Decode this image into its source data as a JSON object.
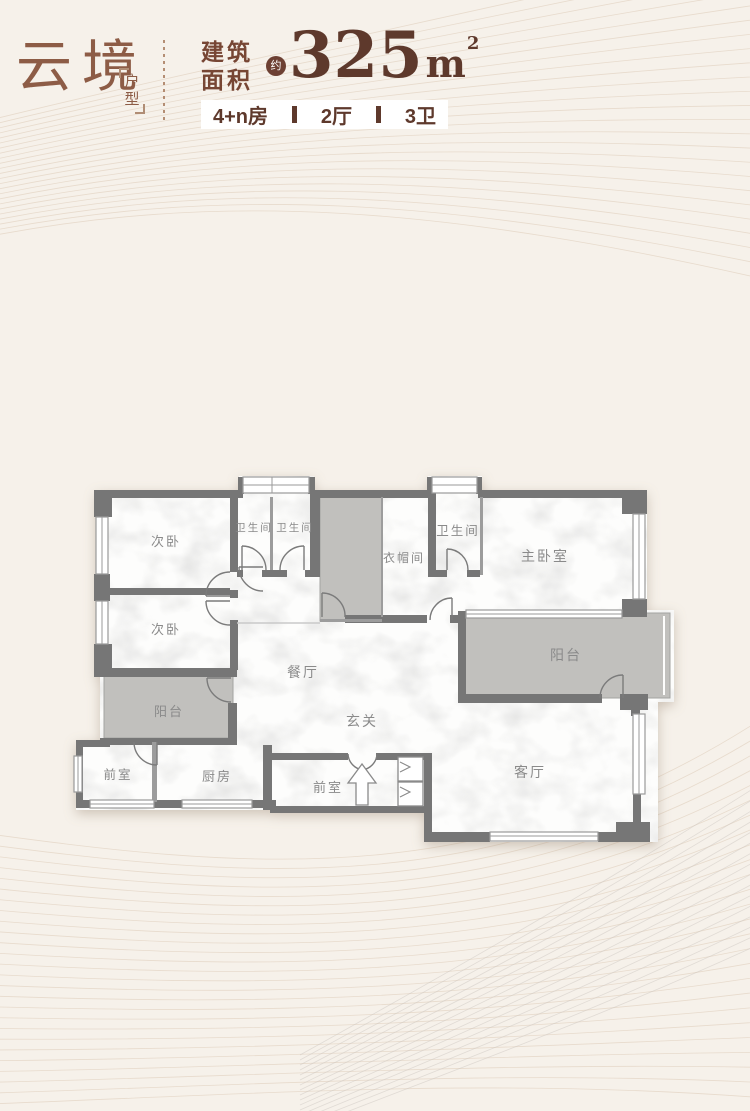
{
  "header": {
    "title": "云境",
    "subtitle": "户型",
    "area_label_1": "建筑",
    "area_label_2": "面积",
    "approx": "约",
    "area_value": "325",
    "unit_base": "m",
    "unit_sup": "2",
    "specs": [
      "4+n房",
      "2厅",
      "3卫"
    ]
  },
  "floorplan": {
    "labels": [
      {
        "id": "bedroom-2",
        "text": "次卧"
      },
      {
        "id": "bedroom-3",
        "text": "次卧"
      },
      {
        "id": "bath-1",
        "text": "卫生间"
      },
      {
        "id": "bath-2",
        "text": "卫生间"
      },
      {
        "id": "cloakroom",
        "text": "衣帽间"
      },
      {
        "id": "bath-master",
        "text": "卫生间"
      },
      {
        "id": "master-bedroom",
        "text": "主卧室"
      },
      {
        "id": "balcony-east",
        "text": "阳台"
      },
      {
        "id": "dining",
        "text": "餐厅"
      },
      {
        "id": "foyer",
        "text": "玄关"
      },
      {
        "id": "balcony-west",
        "text": "阳台"
      },
      {
        "id": "front-room-west",
        "text": "前室"
      },
      {
        "id": "kitchen",
        "text": "厨房"
      },
      {
        "id": "front-room-entry",
        "text": "前室"
      },
      {
        "id": "living",
        "text": "客厅"
      }
    ]
  },
  "colors": {
    "accent": "#8d5c46",
    "dark_brown": "#5e392c",
    "label_brown": "#774634",
    "badge_brown": "#6d4033",
    "wall_gray": "#767676",
    "balcony_gray": "#c1c0bd",
    "room_label_gray": "#8a8a8a",
    "swirl_tan": "#d9c5b0",
    "paper": "#f6f1ea"
  }
}
